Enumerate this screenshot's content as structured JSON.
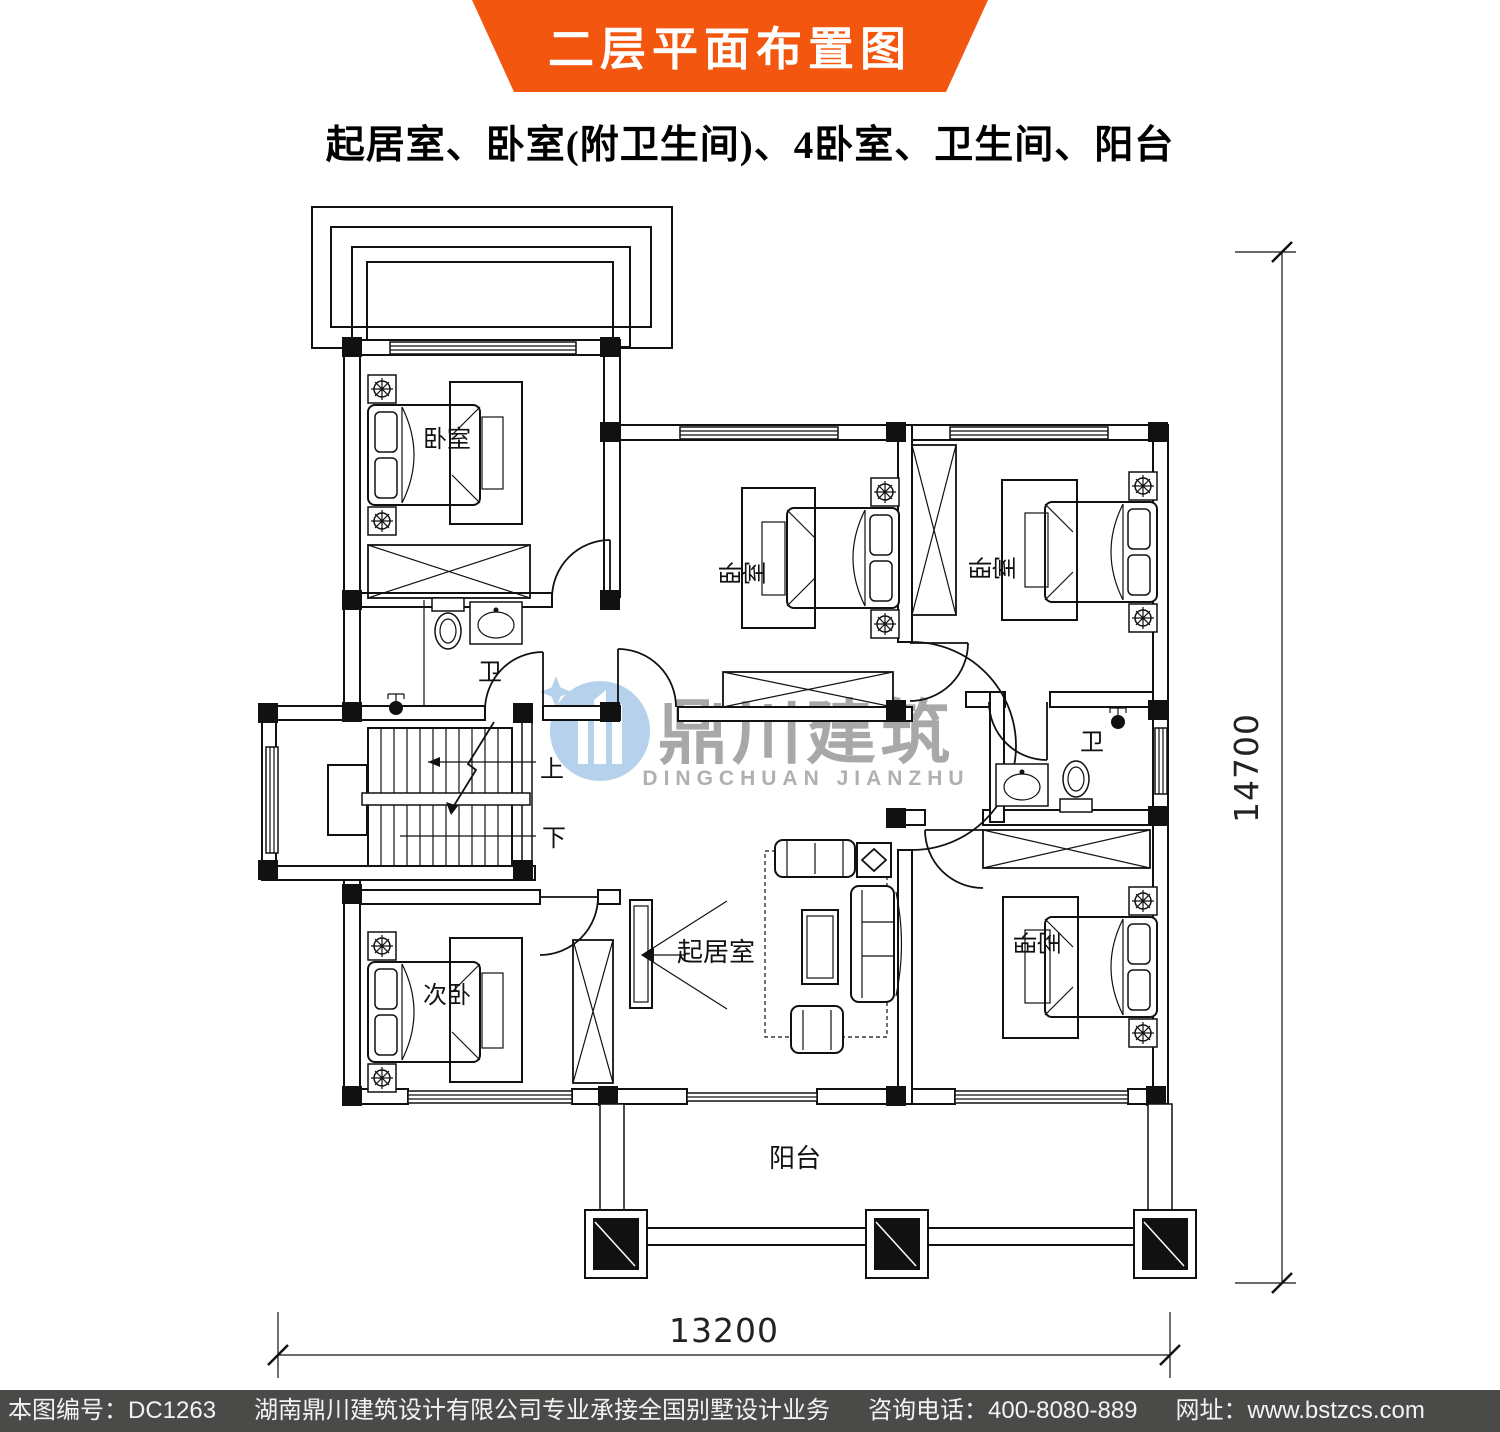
{
  "colors": {
    "banner_bg": "#f2560f",
    "footer_bg": "#4a4a48",
    "footer_text": "#f2f2f2",
    "line": "#111111",
    "watermark_blue": "#aecde9",
    "watermark_gray": "#9f9f9f"
  },
  "banner": {
    "title": "二层平面布置图"
  },
  "subtitle": "起居室、卧室(附卫生间)、4卧室、卫生间、阳台",
  "plan": {
    "rooms": {
      "bedroom_top_left": "卧室",
      "bedroom_middle": "卧室",
      "bedroom_top_right": "卧室",
      "bedroom_bottom_right": "卧室",
      "second_bedroom": "次卧",
      "living_room": "起居室",
      "balcony": "阳台",
      "bathroom_left": "卫",
      "bathroom_right": "卫",
      "stairs_up": "上",
      "stairs_down": "下"
    },
    "dimensions": {
      "bottom_width": "13200",
      "right_height": "14700"
    }
  },
  "watermark": {
    "name_cn": "鼎川建筑",
    "name_en": "DINGCHUAN JIANZHU"
  },
  "footer": {
    "drawing_no": "本图编号：DC1263",
    "company": "湖南鼎川建筑设计有限公司专业承接全国别墅设计业务",
    "phone": "咨询电话：400-8080-889",
    "website": "网址：www.bstzcs.com"
  }
}
